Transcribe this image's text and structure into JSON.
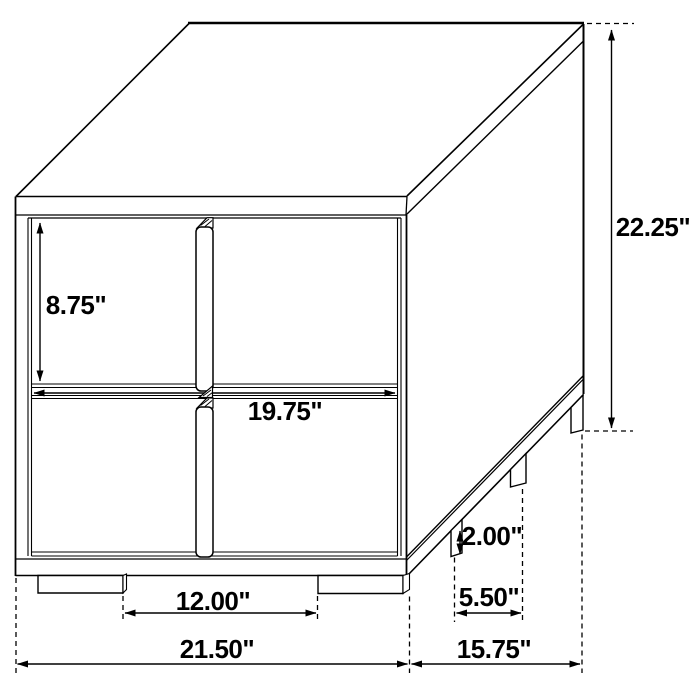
{
  "diagram": {
    "unit": "inches",
    "background_color": "#ffffff",
    "line_color": "#000000",
    "dimensions": {
      "drawer_height": "8.75\"",
      "drawer_width": "19.75\"",
      "overall_height": "22.25\"",
      "leg_height": "2.00\"",
      "side_leg_spacing": "5.50\"",
      "front_leg_spacing": "12.00\"",
      "overall_width": "21.50\"",
      "overall_depth": "15.75\""
    }
  }
}
